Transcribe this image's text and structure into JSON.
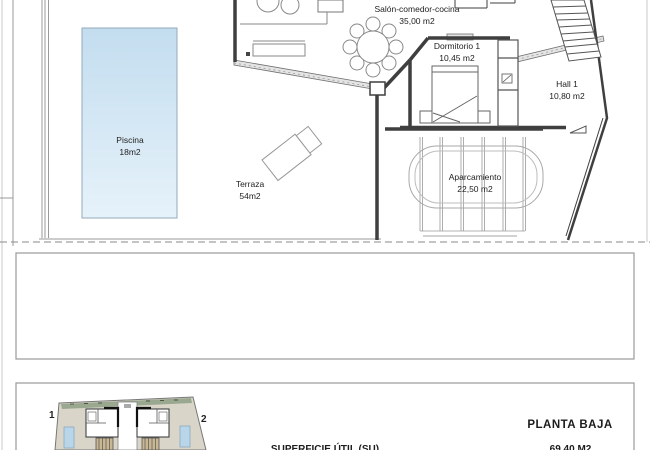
{
  "floor_plan": {
    "rooms": [
      {
        "name": "Piscina",
        "area": "18m2"
      },
      {
        "name": "Salón-comedor-cocina",
        "area": "35,00 m2"
      },
      {
        "name": "Dormitorio 1",
        "area": "10,45 m2"
      },
      {
        "name": "Hall 1",
        "area": "10,80 m2"
      },
      {
        "name": "Terraza",
        "area": "54m2"
      },
      {
        "name": "Aparcamiento",
        "area": "22,50 m2"
      }
    ],
    "colors": {
      "pool_top": "#c3ddef",
      "pool_bottom": "#e6f2fa",
      "wall": "#3f3f3f",
      "thin_line": "#8a8a8a"
    }
  },
  "site_plan": {
    "unit_labels": [
      "1",
      "2"
    ],
    "colors": {
      "ground": "#d9d6c9",
      "green_strip": "#9aa88f",
      "mini_pool": "#b9d5e9",
      "stairs": "#c9b793"
    }
  },
  "footer": {
    "plan_title": "PLANTA BAJA",
    "surface_label": "SUPERFICIE ÚTIL (SU)",
    "surface_value": "69,40 M2"
  }
}
